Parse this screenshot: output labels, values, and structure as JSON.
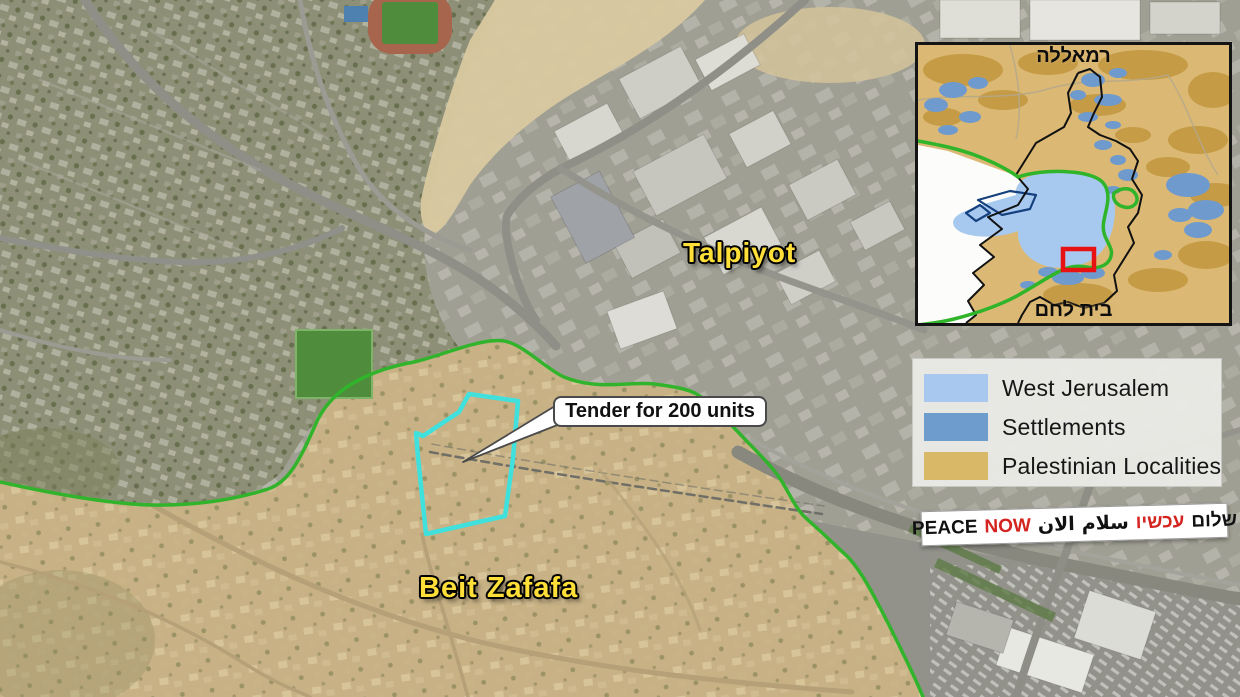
{
  "map": {
    "callout_text": "Tender for 200 units",
    "labels": [
      {
        "text": "Talpiyot"
      },
      {
        "text": "Beit Zafafa"
      }
    ],
    "colors": {
      "tender_site_outline": "#40e0dc",
      "green_line": "#31b42c",
      "place_label_yellow": "#ffdf38"
    }
  },
  "inset": {
    "label_top": "רמאללה",
    "label_bottom": "בית לחם",
    "focus_rect_color": "#e91212"
  },
  "legend": {
    "items": [
      {
        "label": "West Jerusalem",
        "color": "#a9c8ef"
      },
      {
        "label": "Settlements",
        "color": "#6d9ccd"
      },
      {
        "label": "Palestinian Localities",
        "color": "#d9b967"
      }
    ]
  },
  "logo": {
    "segments_left_to_right": [
      {
        "text": "PEACE",
        "color": "#111111"
      },
      {
        "text": "NOW",
        "color": "#d42420"
      },
      {
        "text": "الان",
        "color": "#111111"
      },
      {
        "text": "سلام",
        "color": "#111111"
      },
      {
        "text": "עכשיו",
        "color": "#d42420"
      },
      {
        "text": "שלום",
        "color": "#111111"
      }
    ]
  }
}
